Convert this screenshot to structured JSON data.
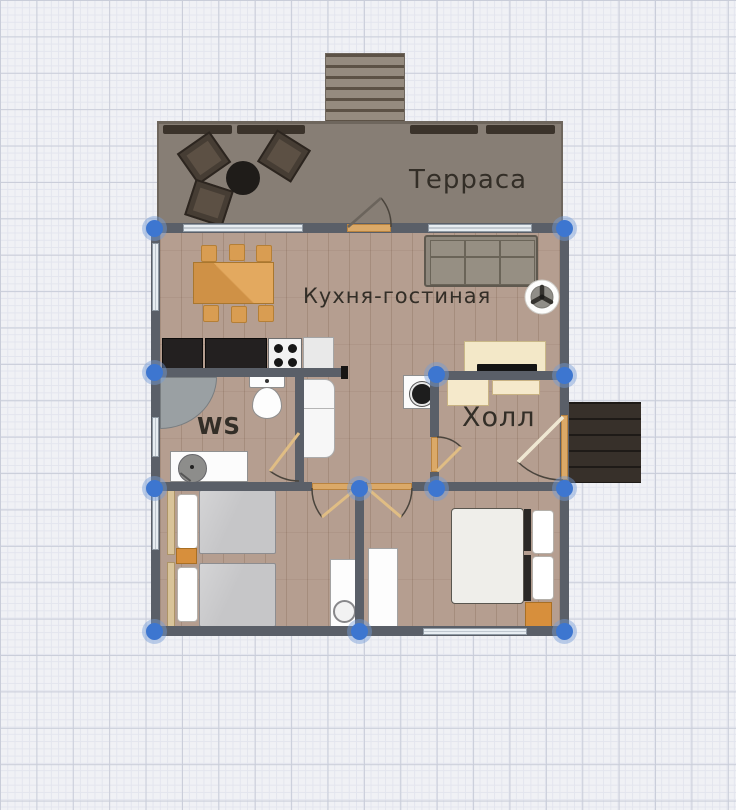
{
  "canvas": {
    "type": "floor-plan-editor-canvas",
    "colors": {
      "canvas_bg": "#f0f1f5",
      "grid_major": "#c9cdd9",
      "grid_minor": "#e3e5ee",
      "wall": "#5a5f68",
      "floor_wood": "#b59e90",
      "terrace_floor": "#877e75",
      "porch_dark": "#37302a",
      "door_threshold": "#dba968",
      "furniture_orange": "#d78f3c",
      "selection_handle_blue": "#3d76d0",
      "kitchen_counter_black": "#232020",
      "label_text": "#332e27"
    }
  },
  "rooms": {
    "terrace": {
      "label": "Терраса"
    },
    "kitchen_living": {
      "label": "Кухня-гостиная"
    },
    "ws": {
      "label": "WS"
    },
    "hall": {
      "label": "Холл"
    }
  },
  "furniture_icons": [
    "terrace-steps",
    "terrace-railing",
    "armchair",
    "round-coffee-table",
    "dining-table",
    "dining-chair",
    "sofa",
    "fan",
    "tv-stand",
    "tv",
    "kitchen-counter",
    "stove",
    "kitchen-sink-cabinet",
    "fridge",
    "corner-shower",
    "toilet",
    "vanity-sink",
    "washing-machine",
    "hall-cabinet",
    "hall-bench",
    "single-bed",
    "nightstand",
    "desk",
    "stool",
    "wardrobe",
    "double-bed",
    "pillow",
    "entrance-porch"
  ],
  "openings": [
    "window",
    "door-terrace",
    "door-ws",
    "door-bedroom-left",
    "door-bedroom-right",
    "door-hall",
    "door-entrance"
  ]
}
